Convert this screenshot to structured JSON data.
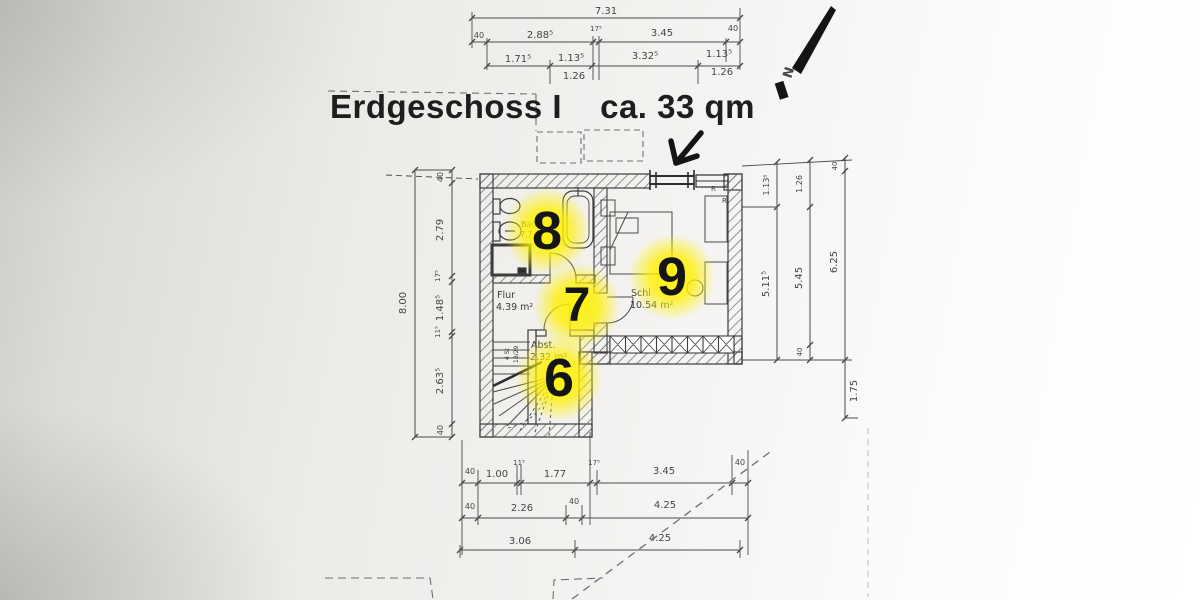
{
  "title": {
    "main": "Erdgeschoss I",
    "area": "ca. 33 qm"
  },
  "compass": {
    "label": "N"
  },
  "rooms": [
    {
      "name": "Bad",
      "area": "7.7",
      "marker": "8"
    },
    {
      "name": "Flur",
      "area": "4.39 m²",
      "marker": "7"
    },
    {
      "name": "Schl",
      "area": "10.54 m²",
      "marker": "9"
    },
    {
      "name": "Abst.",
      "area": "2.32 m²",
      "marker": "6"
    }
  ],
  "stair_note": {
    "line1": "4 St",
    "line2": "18/29"
  },
  "wall_marks": {
    "r1": "R",
    "r2": "R"
  },
  "dimensions": {
    "top": {
      "total": "7.31",
      "row2": [
        "40",
        "2.88⁵",
        "17⁵",
        "3.45",
        "40"
      ],
      "row3": [
        "1.71⁵",
        "1.13⁵",
        "3.32⁵",
        "1.13⁵"
      ],
      "sub": [
        "1.26",
        "1.26"
      ]
    },
    "left": {
      "total": "8.00",
      "segments": [
        "40",
        "2.79",
        "17⁵",
        "1.48⁵",
        "11⁵",
        "2.63⁵",
        "40"
      ]
    },
    "right": {
      "inner": [
        "1.13⁵",
        "5.11⁵"
      ],
      "middle": [
        "1.26",
        "5.45",
        "40"
      ],
      "outer": [
        "40",
        "6.25"
      ],
      "offset": "1.75"
    },
    "bottom": {
      "row1": [
        "40",
        "1.00",
        "11⁵",
        "1.77",
        "17⁵",
        "3.45",
        "40"
      ],
      "row2": [
        "40",
        "2.26",
        "40",
        "4.25"
      ],
      "row3": [
        "3.06",
        "4.25"
      ]
    }
  }
}
